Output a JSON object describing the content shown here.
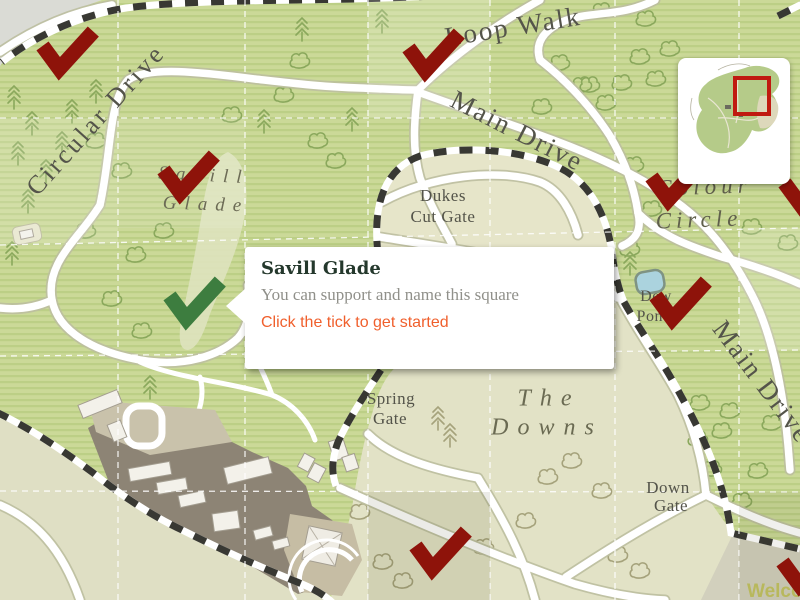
{
  "popup": {
    "title": "Savill Glade",
    "message": "You can support and name this square",
    "cta": "Click the tick to get started"
  },
  "map": {
    "labels": {
      "circular_drive": "Circular Drive",
      "loop_walk": "Loop Walk",
      "main_drive": "Main Drive",
      "main_drive_right": "Main Drive",
      "savill_glade_line1": "Savill",
      "savill_glade_line2": "Glade",
      "dukes_cut_gate_line1": "Dukes",
      "dukes_cut_gate_line2": "Cut Gate",
      "colour_circle_line1": "Colour",
      "colour_circle_line2": "Circle",
      "the_downs_line1": "The",
      "the_downs_line2": "Downs",
      "spring_gate_line1": "Spring",
      "spring_gate_line2": "Gate",
      "down_gate_line1": "Down",
      "down_gate_line2": "Gate",
      "dew_pond_line1": "Dew",
      "dew_pond_line2": "Pond",
      "welcome_partial": "Welco"
    },
    "colors": {
      "tick_claimed": "#8e130a",
      "tick_available": "#3d7d3f",
      "cta_orange": "#f05f2c",
      "minimap_viewport": "#c01a10",
      "welcome_text": "#b8b85c"
    },
    "ticks": [
      {
        "x": 63,
        "y": 56,
        "state": "claimed"
      },
      {
        "x": 429,
        "y": 58,
        "state": "claimed"
      },
      {
        "x": 184,
        "y": 180,
        "state": "claimed"
      },
      {
        "x": 672,
        "y": 187,
        "state": "claimed"
      },
      {
        "x": 805,
        "y": 193,
        "state": "claimed"
      },
      {
        "x": 190,
        "y": 306,
        "state": "available"
      },
      {
        "x": 676,
        "y": 306,
        "state": "claimed"
      },
      {
        "x": 436,
        "y": 556,
        "state": "claimed"
      },
      {
        "x": 803,
        "y": 572,
        "state": "claimed"
      }
    ]
  }
}
